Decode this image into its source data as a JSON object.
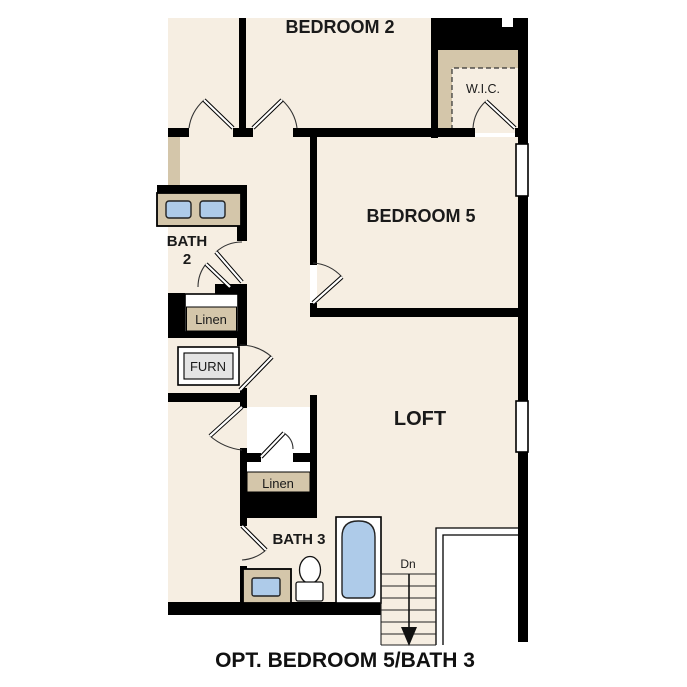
{
  "caption": "OPT. BEDROOM 5/BATH 3",
  "rooms": {
    "bedroom2": "BEDROOM 2",
    "bedroom5": "BEDROOM 5",
    "loft": "LOFT",
    "bath2_line1": "BATH",
    "bath2_line2": "2",
    "bath3": "BATH 3",
    "wic": "W.I.C.",
    "linen_upper": "Linen",
    "linen_lower": "Linen",
    "furnace": "FURN",
    "stairs_down": "Dn"
  },
  "colors": {
    "floor": "#f6eee2",
    "wall": "#000000",
    "casework_tan": "#d4c6aa",
    "fixture_blue": "#aecbe9",
    "furnace_fill": "#e4e4e4",
    "label_text": "#1a1a1a"
  }
}
